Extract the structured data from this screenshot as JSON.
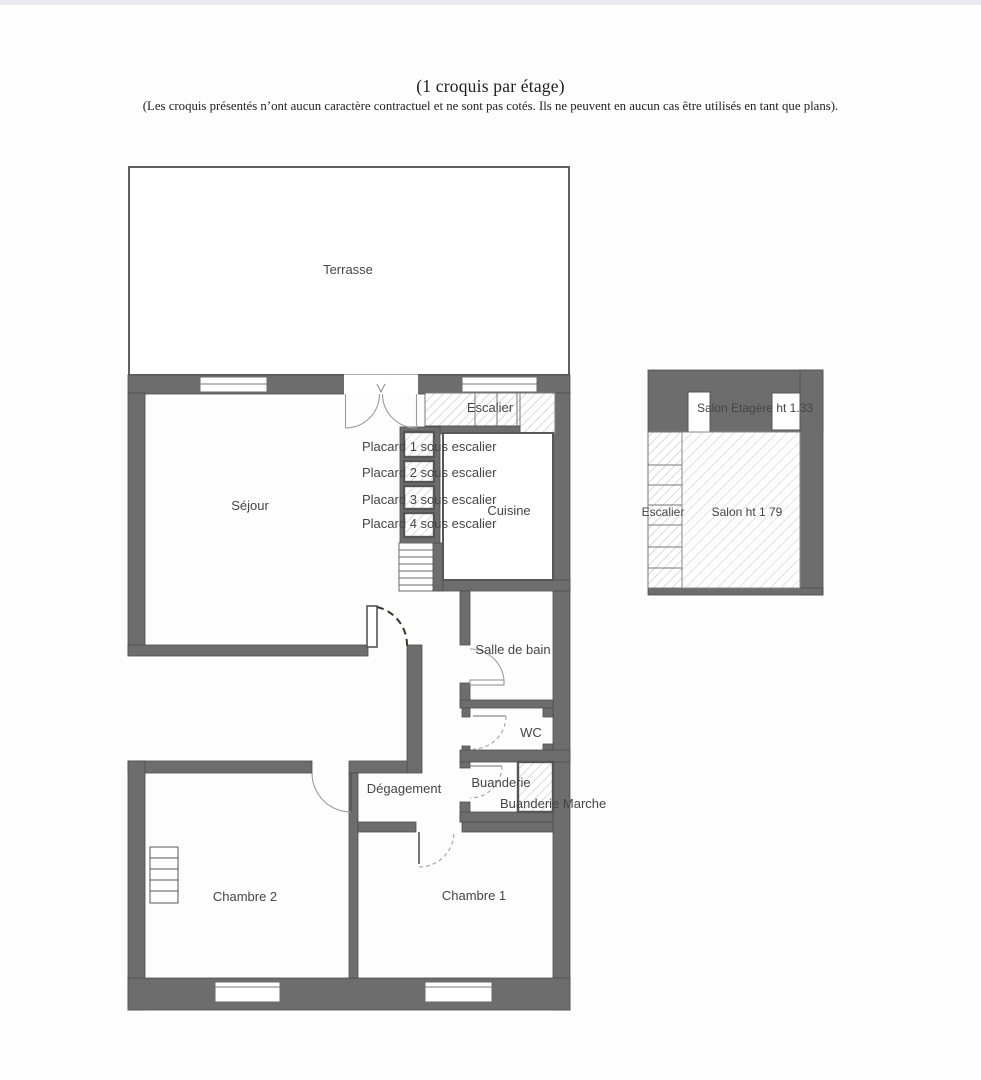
{
  "page": {
    "title": "(1 croquis par étage)",
    "subtitle": "(Les croquis présentés n’ont aucun caractère contractuel et ne sont pas cotés. Ils ne peuvent en aucun cas être utilisés en tant que plans)."
  },
  "floorplan": {
    "rooms": {
      "terrasse": "Terrasse",
      "sejour": "Séjour",
      "escalier": "Escalier",
      "cuisine": "Cuisine",
      "salle_de_bain": "Salle de bain",
      "wc": "WC",
      "buanderie": "Buanderie",
      "buanderie_marche": "Buanderie Marche",
      "degagement": "Dégagement",
      "chambre1": "Chambre 1",
      "chambre2": "Chambre 2"
    },
    "placards": [
      "Placard 1 sous escalier",
      "Placard 2 sous escalier",
      "Placard 3 sous escalier",
      "Placard 4 sous escalier"
    ],
    "annex": {
      "etagere": "Salon Etagère ht 1.33",
      "escalier": "Escalier",
      "salon": "Salon ht 1 79"
    }
  },
  "colors": {
    "wall": "#6d6d6d",
    "wall_edge": "#4c4c4c",
    "hatch": "#c6c6c6",
    "text": "#454545",
    "arc": "#9b9b9b"
  }
}
